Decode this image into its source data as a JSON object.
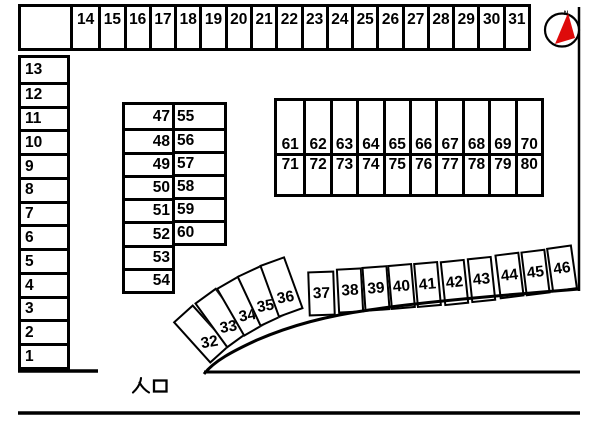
{
  "map_title": "parking-lot-layout",
  "entrance": {
    "label": "入口"
  },
  "compass": {
    "label": "N",
    "needle_color": "#de0b0b"
  },
  "colors": {
    "line": "#000000",
    "background": "#ffffff",
    "needle_red": "#de0b0b"
  },
  "top_row": {
    "spaces": [
      "14",
      "15",
      "16",
      "17",
      "18",
      "19",
      "20",
      "21",
      "22",
      "23",
      "24",
      "25",
      "26",
      "27",
      "28",
      "29",
      "30",
      "31"
    ]
  },
  "left_column": {
    "spaces": [
      "13",
      "12",
      "11",
      "10",
      "9",
      "8",
      "7",
      "6",
      "5",
      "4",
      "3",
      "2",
      "1"
    ]
  },
  "middle_block": {
    "left_spaces": [
      "47",
      "48",
      "49",
      "50",
      "51",
      "52",
      "53",
      "54"
    ],
    "right_spaces": [
      "55",
      "56",
      "57",
      "58",
      "59",
      "60"
    ]
  },
  "right_block": {
    "top_spaces": [
      "61",
      "62",
      "63",
      "64",
      "65",
      "66",
      "67",
      "68",
      "69",
      "70"
    ],
    "bottom_spaces": [
      "71",
      "72",
      "73",
      "74",
      "75",
      "76",
      "77",
      "78",
      "79",
      "80"
    ]
  },
  "curve_spaces": [
    {
      "label": "32",
      "x": 188,
      "y": 306,
      "w": 27,
      "h": 56,
      "rot": -42,
      "label_rot": 32,
      "align": "end"
    },
    {
      "label": "33",
      "x": 208,
      "y": 290,
      "w": 27,
      "h": 56,
      "rot": -36,
      "label_rot": 26,
      "align": "end"
    },
    {
      "label": "34",
      "x": 228,
      "y": 278,
      "w": 27,
      "h": 56,
      "rot": -30,
      "label_rot": 20,
      "align": "end"
    },
    {
      "label": "35",
      "x": 247,
      "y": 268,
      "w": 27,
      "h": 56,
      "rot": -25,
      "label_rot": 15,
      "align": "end"
    },
    {
      "label": "36",
      "x": 268,
      "y": 259,
      "w": 27,
      "h": 56,
      "rot": -20,
      "label_rot": 10,
      "align": "end"
    },
    {
      "label": "37",
      "x": 308,
      "y": 271,
      "w": 27,
      "h": 45,
      "rot": -2,
      "label_rot": 0,
      "align": "center"
    },
    {
      "label": "38",
      "x": 337,
      "y": 268,
      "w": 26,
      "h": 45,
      "rot": -3,
      "label_rot": 0,
      "align": "center"
    },
    {
      "label": "39",
      "x": 363,
      "y": 266,
      "w": 26,
      "h": 45,
      "rot": -4,
      "label_rot": 0,
      "align": "center"
    },
    {
      "label": "40",
      "x": 389,
      "y": 264,
      "w": 25,
      "h": 45,
      "rot": -5,
      "label_rot": 0,
      "align": "center"
    },
    {
      "label": "41",
      "x": 415,
      "y": 262,
      "w": 25,
      "h": 45,
      "rot": -5,
      "label_rot": 0,
      "align": "center"
    },
    {
      "label": "42",
      "x": 442,
      "y": 260,
      "w": 25,
      "h": 45,
      "rot": -6,
      "label_rot": 0,
      "align": "center"
    },
    {
      "label": "43",
      "x": 469,
      "y": 257,
      "w": 25,
      "h": 45,
      "rot": -6,
      "label_rot": 0,
      "align": "center"
    },
    {
      "label": "44",
      "x": 497,
      "y": 253,
      "w": 25,
      "h": 45,
      "rot": -7,
      "label_rot": 0,
      "align": "center"
    },
    {
      "label": "45",
      "x": 523,
      "y": 250,
      "w": 25,
      "h": 45,
      "rot": -7,
      "label_rot": 0,
      "align": "center"
    },
    {
      "label": "46",
      "x": 549,
      "y": 246,
      "w": 26,
      "h": 45,
      "rot": -8,
      "label_rot": 0,
      "align": "center"
    }
  ]
}
